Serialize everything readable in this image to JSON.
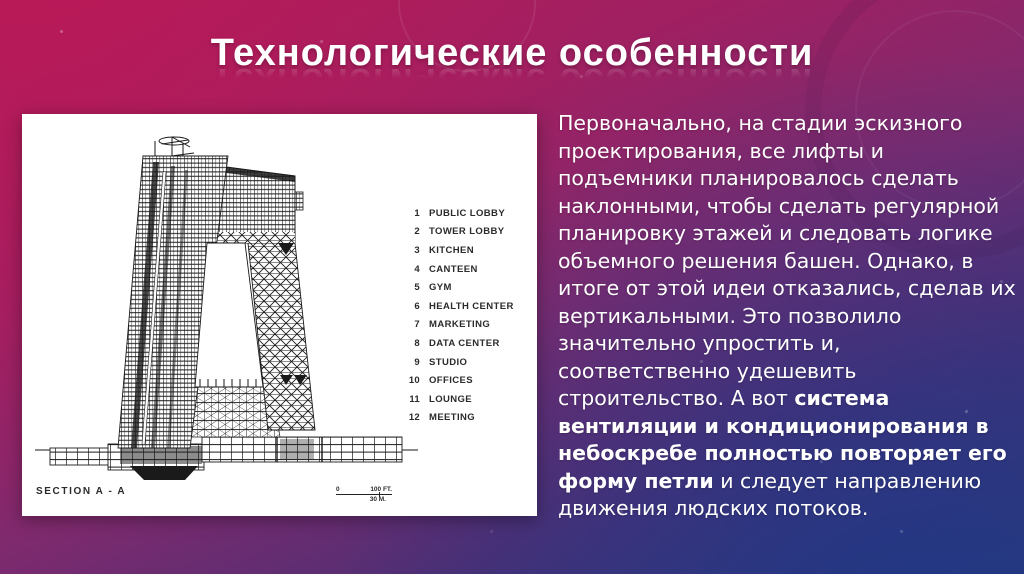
{
  "slide": {
    "title": "Технологические особенности",
    "colors": {
      "bg_top_left": "#b11d57",
      "bg_mid": "#7e2a6e",
      "bg_bottom_right": "#2b3a76",
      "panel": "#ffffff",
      "drawing_ink": "#1a1a1a",
      "text": "#ffffff"
    }
  },
  "figure": {
    "section_label": "SECTION A - A",
    "scale": {
      "zero": "0",
      "feet": "100 FT.",
      "meters": "30 M."
    },
    "legend": [
      {
        "num": "1",
        "label": "PUBLIC LOBBY"
      },
      {
        "num": "2",
        "label": "TOWER LOBBY"
      },
      {
        "num": "3",
        "label": "KITCHEN"
      },
      {
        "num": "4",
        "label": "CANTEEN"
      },
      {
        "num": "5",
        "label": "GYM"
      },
      {
        "num": "6",
        "label": "HEALTH CENTER"
      },
      {
        "num": "7",
        "label": "MARKETING"
      },
      {
        "num": "8",
        "label": "DATA CENTER"
      },
      {
        "num": "9",
        "label": "STUDIO"
      },
      {
        "num": "10",
        "label": "OFFICES"
      },
      {
        "num": "11",
        "label": "LOUNGE"
      },
      {
        "num": "12",
        "label": "MEETING"
      }
    ]
  },
  "body": {
    "text_before": "Первоначально, на стадии эскизного проектирования, все лифты и подъемники планировалось сделать наклонными, чтобы сделать регулярной планировку этажей и следовать логике объемного решения башен. Однако, в итоге от этой идеи отказались, сделав их вертикальными. Это позволило значительно упростить и, соответственно удешевить строительство. А вот ",
    "text_bold": "система вентиляции и кондиционирования в небоскребе полностью повторяет его форму петли",
    "text_after": " и следует направлению движения людских потоков."
  }
}
